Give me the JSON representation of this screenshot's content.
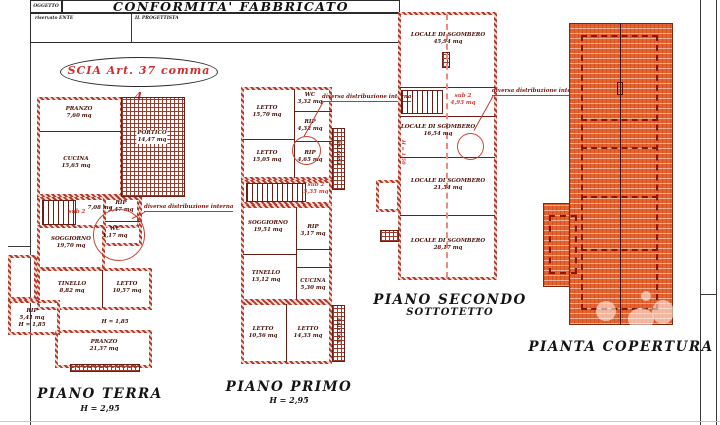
{
  "header": {
    "oggetto_label": "OGGETTO",
    "title": "CONFORMITA'  FABBRICATO",
    "left_label": "riservato ENTE",
    "right_label": "IL PROGETTISTA",
    "stamp": "SCIA Art. 37 comma 4"
  },
  "annotation": "diversa distribuzione interna",
  "colors": {
    "wall_red": "#b03a2e",
    "annotation_red": "#cc2222",
    "stamp_red": "#d42b2b",
    "roof_orange": "#e7632c"
  },
  "plans": {
    "terra": {
      "title": "PIANO TERRA",
      "height": "H = 2,95",
      "sub": "sub 2",
      "h_note": "H = 1,85",
      "rooms": {
        "pranzo1": {
          "name": "PRANZO",
          "area": "7,60 mq"
        },
        "portico": {
          "name": "PORTICO",
          "area": "14,47 mq"
        },
        "cucina": {
          "name": "CUCINA",
          "area": "15,65 mq"
        },
        "hall": {
          "name": "",
          "area": "7,08 mq"
        },
        "rip1": {
          "name": "RIP",
          "area": "2,47 mq"
        },
        "wc": {
          "name": "WC",
          "area": "1,17 mq"
        },
        "soggiorno": {
          "name": "SOGGIORNO",
          "area": "19,70 mq"
        },
        "tinello": {
          "name": "TINELLO",
          "area": "8,82 mq"
        },
        "letto": {
          "name": "LETTO",
          "area": "10,57 mq"
        },
        "rip2": {
          "name": "RIP",
          "area": "5,41 mq"
        },
        "pranzo2": {
          "name": "PRANZO",
          "area": "21,37 mq"
        }
      }
    },
    "primo": {
      "title": "PIANO PRIMO",
      "height": "H = 2,95",
      "sub": "sub 2",
      "sub_area": "5,35 mq",
      "balcone": "BALCONE",
      "rooms": {
        "letto1": {
          "name": "LETTO",
          "area": "15,70 mq"
        },
        "wc": {
          "name": "WC",
          "area": "3,32 mq"
        },
        "rip1": {
          "name": "RIP",
          "area": "4,32 mq"
        },
        "letto2": {
          "name": "LETTO",
          "area": "15,05 mq"
        },
        "rip2": {
          "name": "RIP",
          "area": "4,65 mq"
        },
        "soggiorno": {
          "name": "SOGGIORNO",
          "area": "19,51 mq"
        },
        "rip3": {
          "name": "RIP",
          "area": "3,17 mq"
        },
        "tinello": {
          "name": "TINELLO",
          "area": "13,12 mq"
        },
        "cucina": {
          "name": "CUCINA",
          "area": "5,30 mq"
        },
        "letto3": {
          "name": "LETTO",
          "area": "10,56 mq"
        },
        "letto4": {
          "name": "LETTO",
          "area": "14,33 mq"
        }
      }
    },
    "secondo": {
      "title": "PIANO SECONDO",
      "subtitle": "SOTTOTETTO",
      "sub": "sub 2",
      "sub_area": "4,93 mq",
      "h_note": "H = 1,50",
      "rooms": {
        "loc1": {
          "name": "LOCALE DI SGOMBERO",
          "area": "45,94 mq"
        },
        "loc2": {
          "name": "LOCALE DI SGOMBERO",
          "area": "16,54 mq"
        },
        "loc3": {
          "name": "LOCALE DI SGOMBERO",
          "area": "21,54 mq"
        },
        "loc4": {
          "name": "LOCALE DI SGOMBERO",
          "area": "28,17 mq"
        }
      }
    },
    "copertura": {
      "title": "PIANTA COPERTURA"
    }
  }
}
